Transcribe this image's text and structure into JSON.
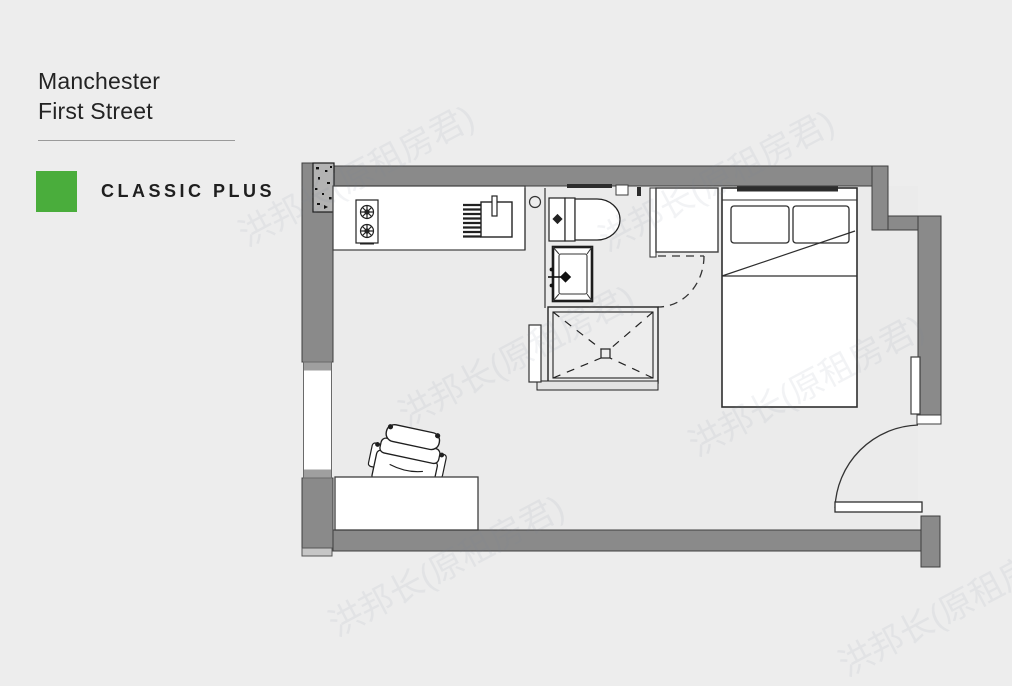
{
  "page": {
    "background_color": "#ededed",
    "watermark_text": "洪邦长(原租房君)"
  },
  "header": {
    "title_line1": "Manchester",
    "title_line2": "First Street"
  },
  "brand": {
    "name": "CLASSIC PLUS",
    "logo_color": "#4aad3c"
  },
  "floorplan": {
    "wall_color": "#8a8a8a",
    "outline_color": "#3e3e3e",
    "fixture_fill": "#ffffff",
    "fixtures": [
      {
        "name": "structural-column"
      },
      {
        "name": "kitchen-counter"
      },
      {
        "name": "hob"
      },
      {
        "name": "kitchen-sink"
      },
      {
        "name": "toilet"
      },
      {
        "name": "wash-basin"
      },
      {
        "name": "shower"
      },
      {
        "name": "shower-screen"
      },
      {
        "name": "bathroom-door"
      },
      {
        "name": "wardrobe"
      },
      {
        "name": "double-bed"
      },
      {
        "name": "desk"
      },
      {
        "name": "desk-chair"
      },
      {
        "name": "entrance-door"
      },
      {
        "name": "window-left"
      },
      {
        "name": "window-right"
      }
    ]
  }
}
